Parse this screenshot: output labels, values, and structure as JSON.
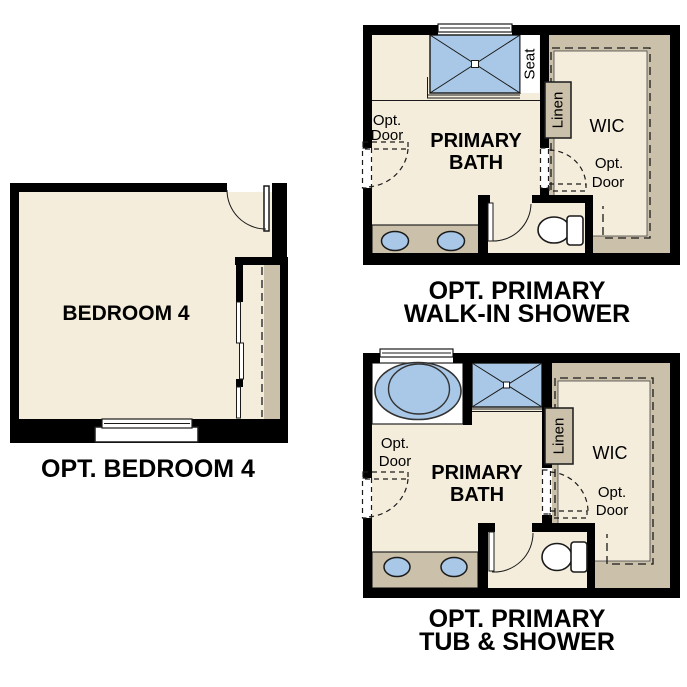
{
  "colors": {
    "background": "#ffffff",
    "wall": "#000000",
    "floor": "#f4eddc",
    "carpet_tan": "#cbc1aa",
    "fixture_blue": "#a9c8e7",
    "text": "#000000"
  },
  "bedroom": {
    "room_label": "BEDROOM 4",
    "caption": "OPT. BEDROOM 4"
  },
  "walk_in_shower_bath": {
    "room_label_line1": "PRIMARY",
    "room_label_line2": "BATH",
    "seat_label": "Seat",
    "linen_label": "Linen",
    "wic_label": "WIC",
    "opt_door_left_line1": "Opt.",
    "opt_door_left_line2": "Door",
    "opt_door_right_line1": "Opt.",
    "opt_door_right_line2": "Door",
    "caption_line1": "OPT. PRIMARY",
    "caption_line2": "WALK-IN SHOWER"
  },
  "tub_shower_bath": {
    "room_label_line1": "PRIMARY",
    "room_label_line2": "BATH",
    "linen_label": "Linen",
    "wic_label": "WIC",
    "opt_door_left_line1": "Opt.",
    "opt_door_left_line2": "Door",
    "opt_door_right_line1": "Opt.",
    "opt_door_right_line2": "Door",
    "caption_line1": "OPT. PRIMARY",
    "caption_line2": "TUB & SHOWER"
  }
}
